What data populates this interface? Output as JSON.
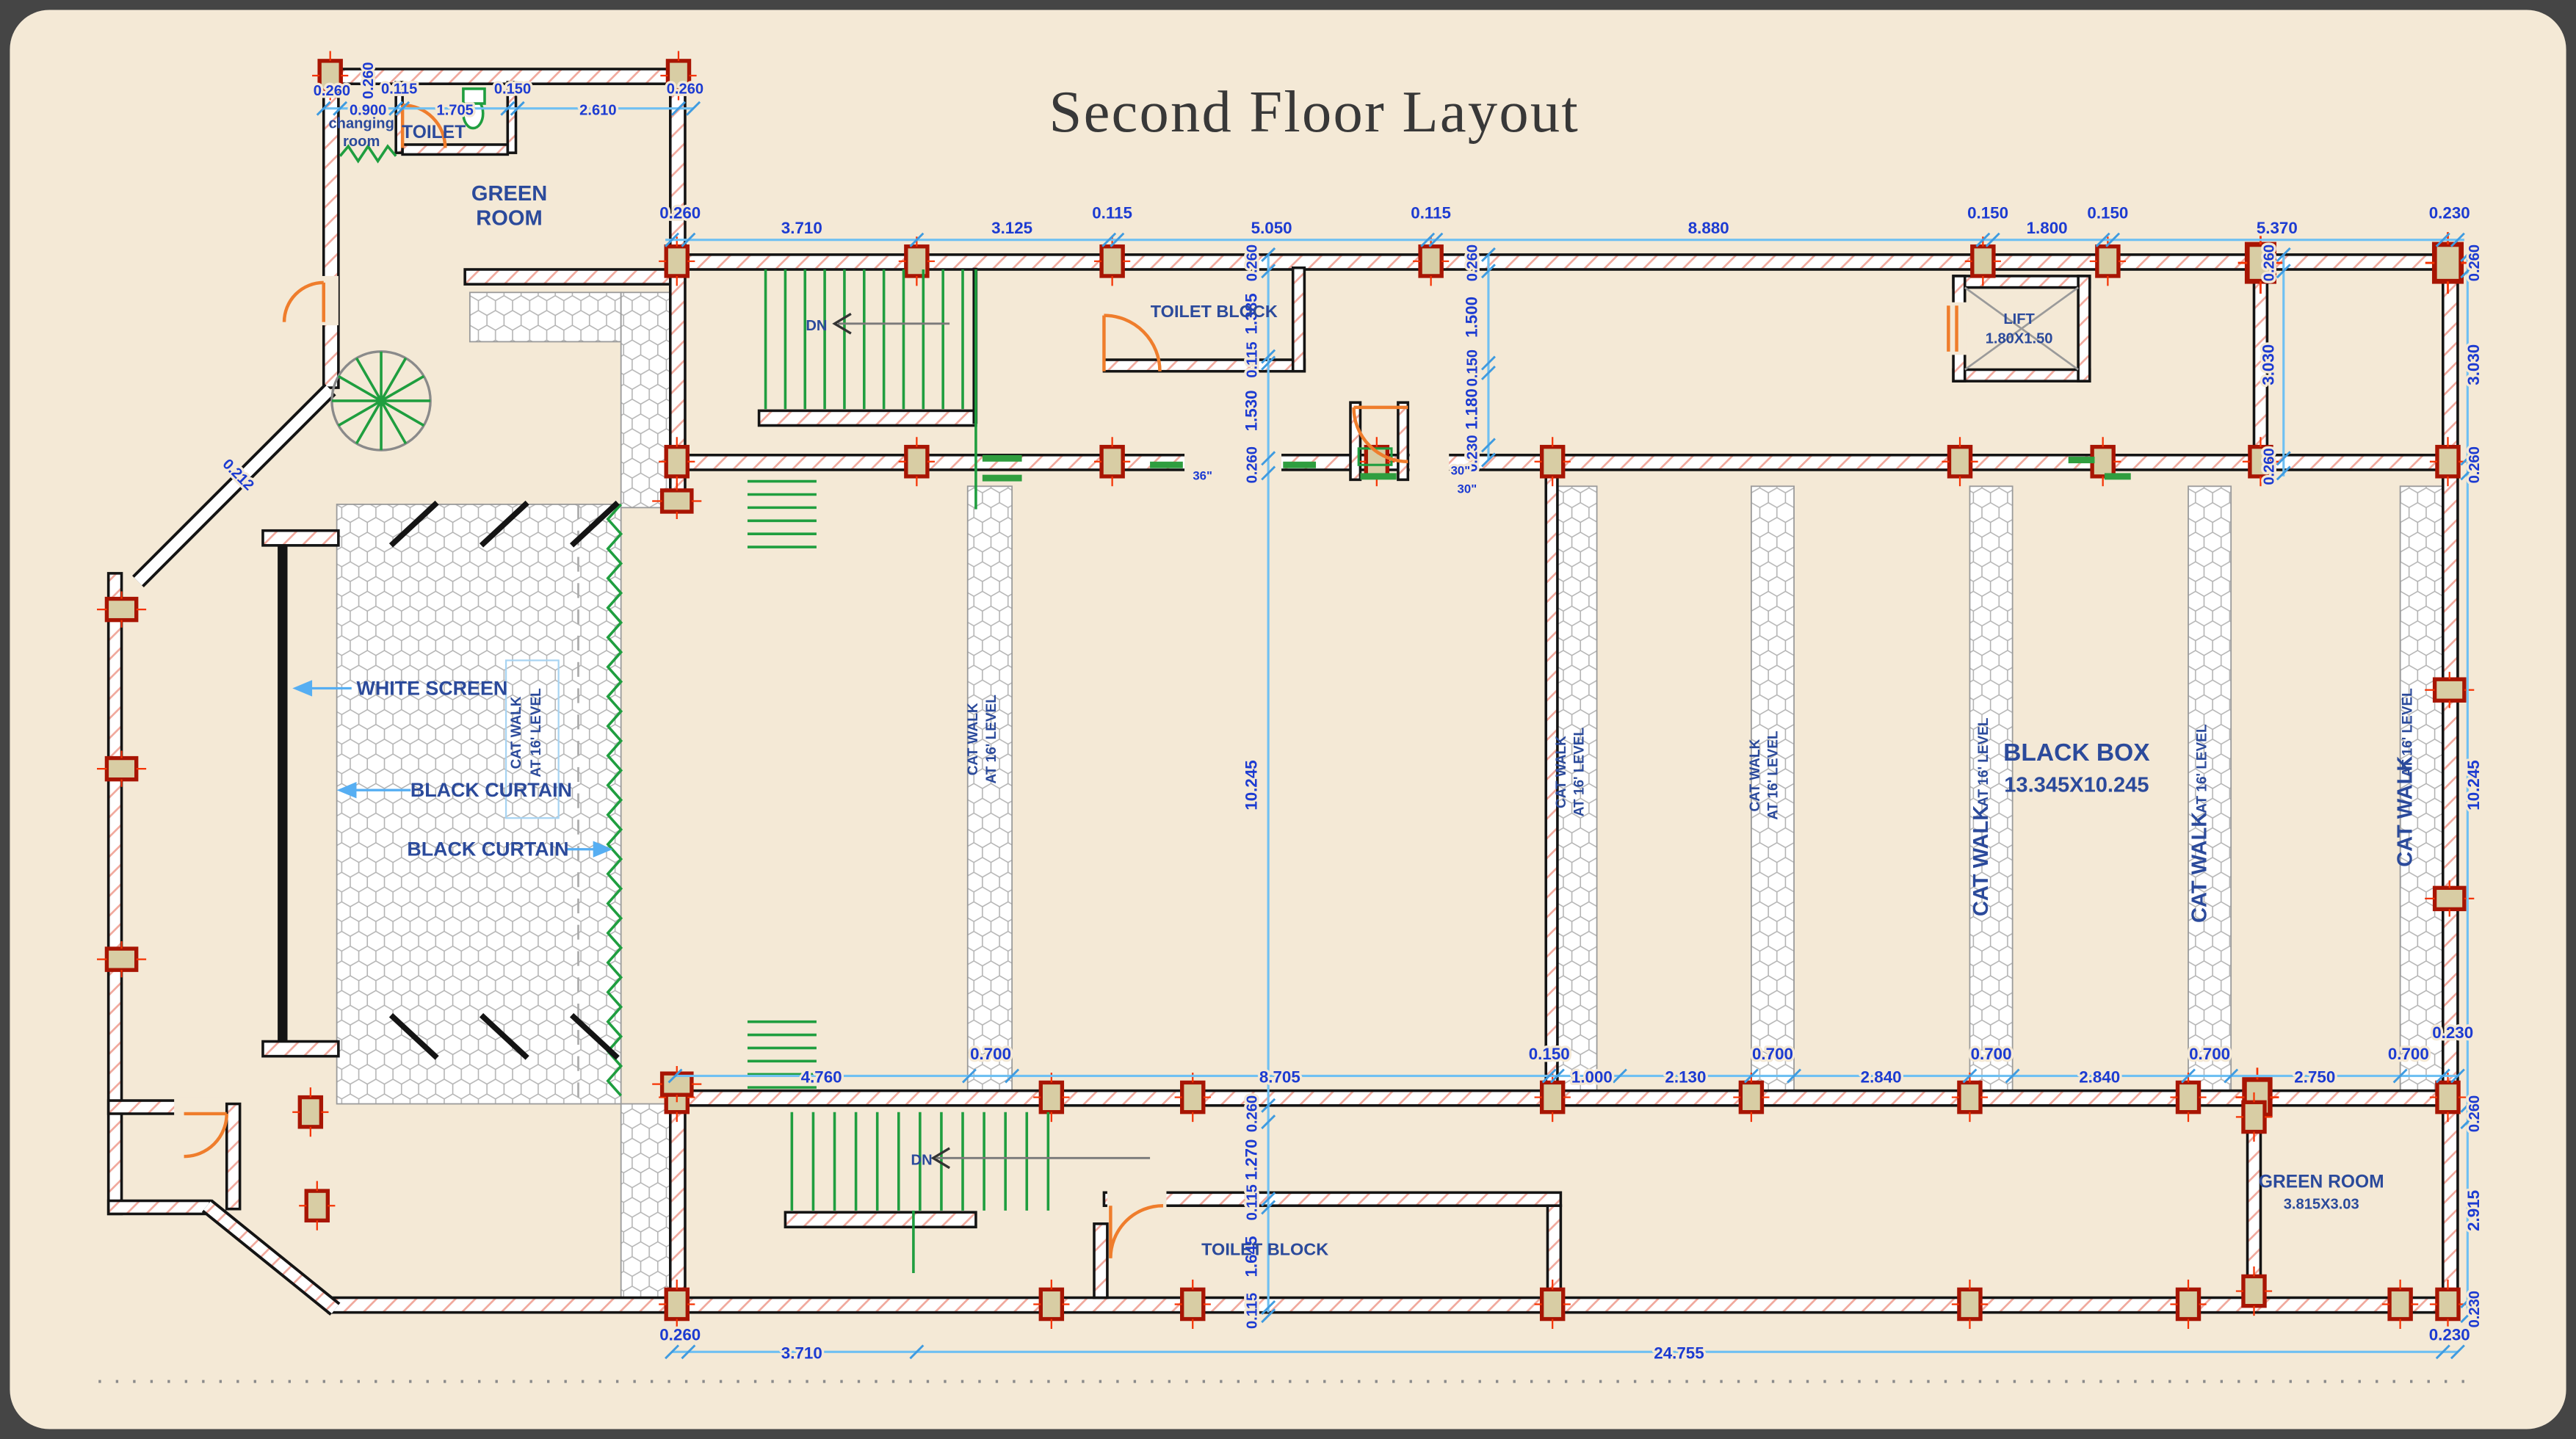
{
  "title": "Second Floor Layout",
  "labels": {
    "changing_room_1": "changing",
    "changing_room_2": "room",
    "toilet": "TOILET",
    "green_room_1": "GREEN",
    "green_room_2": "ROOM",
    "toilet_block_top": "TOILET BLOCK",
    "toilet_block_bottom": "TOILET BLOCK",
    "lift": "LIFT",
    "lift_size": "1.80X1.50",
    "black_box": "BLACK BOX",
    "black_box_size": "13.345X10.245",
    "green_room_b": "GREEN ROOM",
    "green_room_b_size": "3.815X3.03",
    "white_screen": "WHITE SCREEN",
    "black_curtain": "BLACK CURTAIN",
    "cat_walk": "CAT WALK",
    "cat_level": "AT 16' LEVEL",
    "dn": "DN"
  },
  "dims": {
    "room_top": [
      "0.260",
      "0.900",
      "0.115",
      "1.705",
      "0.150",
      "2.610",
      "0.260"
    ],
    "room_top_wall": "0.260",
    "top": [
      "0.260",
      "3.710",
      "3.125",
      "0.115",
      "5.050",
      "0.115",
      "8.880",
      "0.150",
      "1.800",
      "0.150",
      "5.370",
      "0.230"
    ],
    "mid": [
      "4.760",
      "0.700",
      "8.705",
      "0.150",
      "1.000",
      "2.130",
      "0.700",
      "2.840",
      "0.700",
      "2.840",
      "0.700",
      "2.750",
      "0.700",
      "0.230"
    ],
    "bottom": [
      "0.260",
      "3.710",
      "24.755",
      "0.230"
    ],
    "center": [
      "0.260",
      "1.385",
      "0.115",
      "1.530",
      "0.260",
      "10.245",
      "0.260",
      "1.270",
      "0.115",
      "1.645",
      "0.115"
    ],
    "inner_right": [
      "0.260",
      "1.500",
      "0.150",
      "1.180",
      "0.230"
    ],
    "lift_side": [
      "0.260",
      "3.030",
      "0.260"
    ],
    "right": [
      "0.260",
      "3.030",
      "0.260",
      "10.245",
      "0.260",
      "2.915",
      "0.230"
    ],
    "angled_wall": "0.212",
    "door_36": "36\"",
    "door_30a": "30\"",
    "door_30b": "30\""
  },
  "colors": {
    "paper": "#f4e9d6",
    "dim_text": "#1c3bd1",
    "dim_line": "#6fc0f2",
    "room_text": "#2b4a9b",
    "wall": "#141414",
    "hatch": "#f0a89c",
    "column_fill": "#d8cda4",
    "column_stroke": "#a81503",
    "door": "#ef7d2c",
    "stair": "#1f9e3f"
  }
}
